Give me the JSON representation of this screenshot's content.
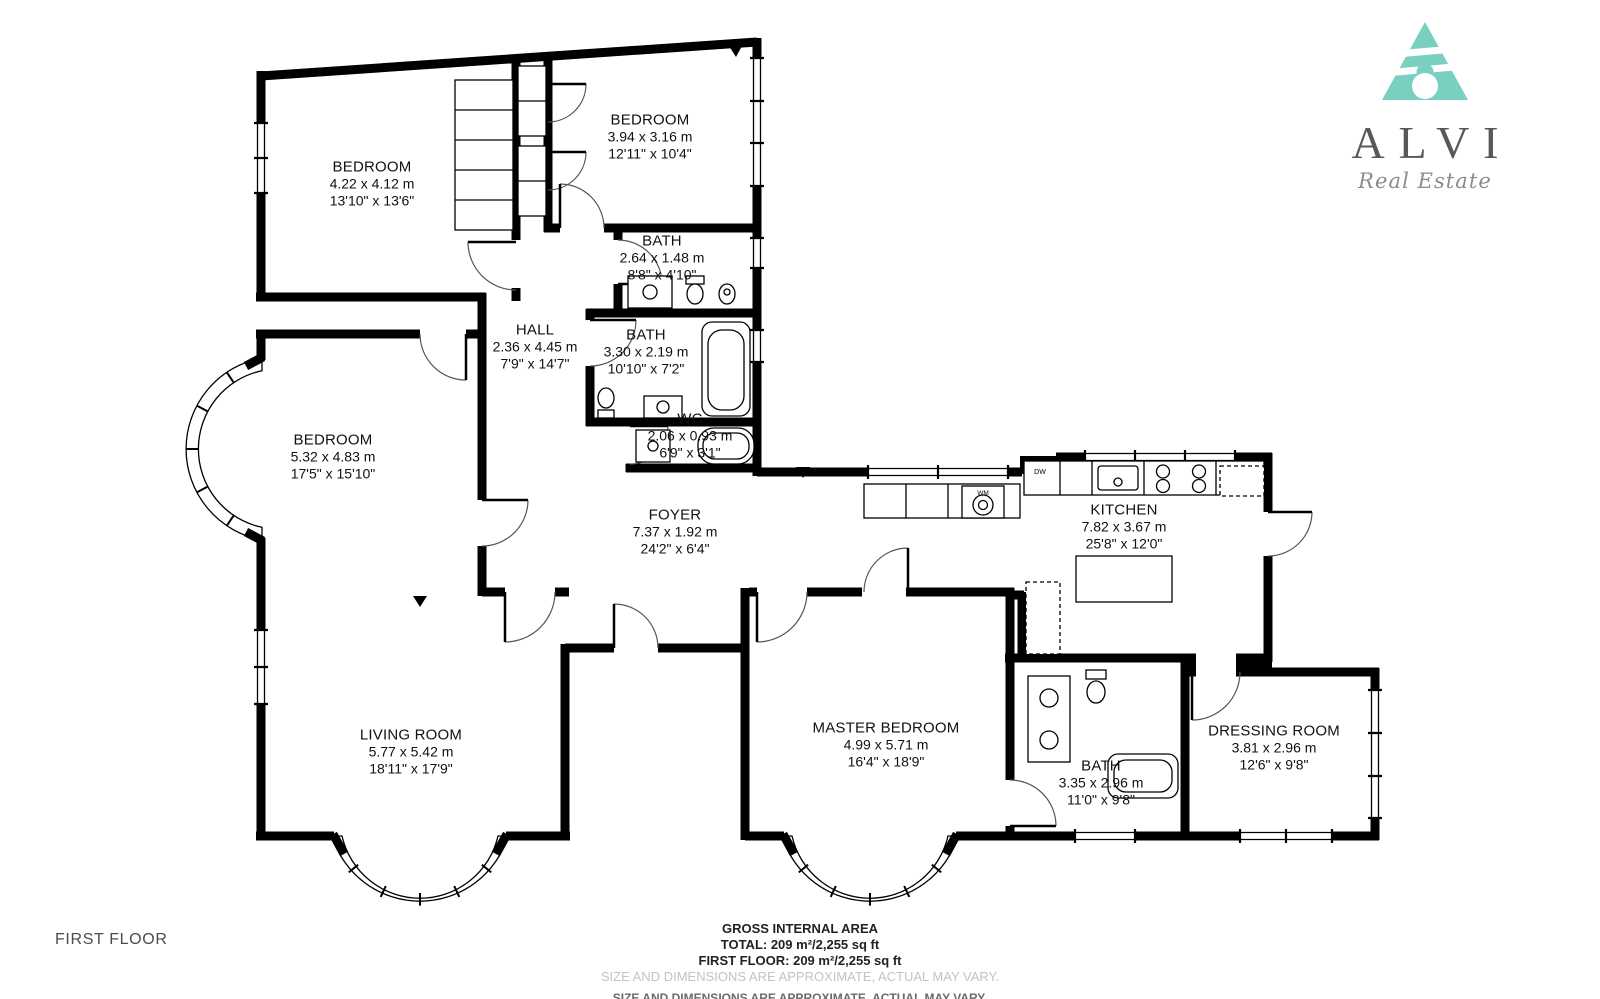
{
  "branding": {
    "name": "ALVI",
    "tagline": "Real Estate",
    "logo_color": "#79cfc0"
  },
  "floor": {
    "label": "FIRST FLOOR"
  },
  "footer": {
    "heading": "GROSS INTERNAL AREA",
    "total": "TOTAL: 209 m²/2,255 sq ft",
    "first_floor": "FIRST FLOOR: 209 m²/2,255 sq ft",
    "disclaimer": "SIZE AND DIMENSIONS ARE APPROXIMATE, ACTUAL MAY VARY."
  },
  "fixtures": {
    "washing_machine": "WM",
    "dishwasher": "DW"
  },
  "rooms": [
    {
      "name": "BEDROOM",
      "metric": "4.22 x 4.12 m",
      "imperial": "13'10\" x 13'6\"",
      "x": 372,
      "y": 184
    },
    {
      "name": "BEDROOM",
      "metric": "3.94 x 3.16 m",
      "imperial": "12'11\" x 10'4\"",
      "x": 650,
      "y": 137
    },
    {
      "name": "BATH",
      "metric": "2.64 x 1.48 m",
      "imperial": "8'8\" x 4'10\"",
      "x": 662,
      "y": 258
    },
    {
      "name": "HALL",
      "metric": "2.36 x 4.45 m",
      "imperial": "7'9\" x 14'7\"",
      "x": 535,
      "y": 347
    },
    {
      "name": "BATH",
      "metric": "3.30 x 2.19 m",
      "imperial": "10'10\" x 7'2\"",
      "x": 646,
      "y": 352
    },
    {
      "name": "WC",
      "metric": "2.06 x 0.93 m",
      "imperial": "6'9\" x 3'1\"",
      "x": 690,
      "y": 436
    },
    {
      "name": "BEDROOM",
      "metric": "5.32 x 4.83 m",
      "imperial": "17'5\" x 15'10\"",
      "x": 333,
      "y": 457
    },
    {
      "name": "FOYER",
      "metric": "7.37 x 1.92 m",
      "imperial": "24'2\" x 6'4\"",
      "x": 675,
      "y": 532
    },
    {
      "name": "KITCHEN",
      "metric": "7.82 x 3.67 m",
      "imperial": "25'8\" x 12'0\"",
      "x": 1124,
      "y": 527
    },
    {
      "name": "LIVING ROOM",
      "metric": "5.77 x 5.42 m",
      "imperial": "18'11\" x 17'9\"",
      "x": 411,
      "y": 752
    },
    {
      "name": "MASTER BEDROOM",
      "metric": "4.99 x 5.71 m",
      "imperial": "16'4\" x 18'9\"",
      "x": 886,
      "y": 745
    },
    {
      "name": "BATH",
      "metric": "3.35 x 2.96 m",
      "imperial": "11'0\" x 9'8\"",
      "x": 1101,
      "y": 783
    },
    {
      "name": "DRESSING ROOM",
      "metric": "3.81 x 2.96 m",
      "imperial": "12'6\" x 9'8\"",
      "x": 1274,
      "y": 748
    }
  ]
}
